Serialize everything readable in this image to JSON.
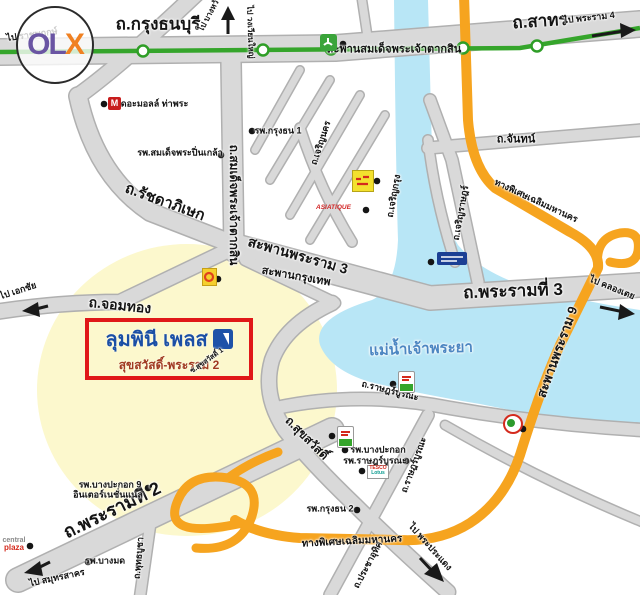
{
  "watermark": {
    "o": "O",
    "l": "L",
    "x": "X",
    "colors": {
      "ol": "#6a55a3",
      "x": "#f08122"
    }
  },
  "property": {
    "name": "ลุมพินี เพลส",
    "subtitle": "สุขสวัสดิ์-พระราม 2"
  },
  "landmarks": {
    "mall_logo": "M",
    "asiatique": "ASIATIQUE",
    "tesco_line1": "TESCO",
    "tesco_line2": "Lotus",
    "central_line1": "central",
    "central_line2": "plaza"
  },
  "colors": {
    "road_gray": "#d9d9d9",
    "road_casing": "#b0b0b0",
    "bts_green": "#35a52b",
    "expressway_orange": "#f6a41f",
    "river_blue": "#b8e6f6",
    "river_label_blue": "#4c86c2",
    "highlight_yellow": "#fcf8cd",
    "box_red": "#e01818",
    "lpn_blue": "#1e52a8"
  },
  "labels": [
    {
      "id": "krungthonburi-rd",
      "text": "ถ.กรุงธนบุรี",
      "x": 158,
      "y": 24,
      "fs": 17,
      "rot": 0
    },
    {
      "id": "sathorn-rd",
      "text": "ถ.สาทร",
      "x": 540,
      "y": 21,
      "fs": 17,
      "rot": -4
    },
    {
      "id": "taksin-rd",
      "text": "ถ.สมเด็จพระเจ้าตากสิน",
      "x": 234,
      "y": 205,
      "fs": 12,
      "rot": 90
    },
    {
      "id": "ratchadaphisek-rd",
      "text": "ถ.รัชดาภิเษก",
      "x": 165,
      "y": 202,
      "fs": 15,
      "rot": 20
    },
    {
      "id": "rama3-bridge",
      "text": "สะพานพระราม 3",
      "x": 298,
      "y": 255,
      "fs": 14,
      "rot": 16
    },
    {
      "id": "krungthep-bridge",
      "text": "สะพานกรุงเทพ",
      "x": 296,
      "y": 277,
      "fs": 11,
      "rot": 10
    },
    {
      "id": "rama3-rd",
      "text": "ถ.พระรามที่ 3",
      "x": 513,
      "y": 291,
      "fs": 17,
      "rot": -2
    },
    {
      "id": "chomthong-rd",
      "text": "ถ.จอมทอง",
      "x": 120,
      "y": 305,
      "fs": 14,
      "rot": 6
    },
    {
      "id": "chan-rd",
      "text": "ถ.จันทน์",
      "x": 516,
      "y": 140,
      "fs": 11,
      "rot": 0
    },
    {
      "id": "charoennakhon-rd",
      "text": "ถ.เจริญนคร",
      "x": 321,
      "y": 143,
      "fs": 9,
      "rot": -72
    },
    {
      "id": "charoenkrung-rd",
      "text": "ถ.เจริญกรุง",
      "x": 394,
      "y": 196,
      "fs": 9,
      "rot": -80
    },
    {
      "id": "charoenrat-rd",
      "text": "ถ.เจริญราษฎร์",
      "x": 461,
      "y": 213,
      "fs": 9,
      "rot": -80
    },
    {
      "id": "ratburana-rd-ew",
      "text": "ถ.ราษฎร์บูรณะ",
      "x": 390,
      "y": 391,
      "fs": 9,
      "rot": 14
    },
    {
      "id": "ratburana-rd-ns",
      "text": "ถ.ราษฎร์บูรณะ",
      "x": 414,
      "y": 465,
      "fs": 9,
      "rot": -70
    },
    {
      "id": "suksawat-rd",
      "text": "ถ.สุขสวัสดิ์",
      "x": 307,
      "y": 438,
      "fs": 12,
      "rot": 45
    },
    {
      "id": "rama2-rd",
      "text": "ถ.พระรามที่ 2",
      "x": 112,
      "y": 510,
      "fs": 18,
      "rot": -26
    },
    {
      "id": "prachauthit-rd",
      "text": "ถ.ประชาอุทิศ",
      "x": 368,
      "y": 565,
      "fs": 9,
      "rot": -62
    },
    {
      "id": "phutthabucha-rd",
      "text": "ถ.พุทธบูชา",
      "x": 139,
      "y": 558,
      "fs": 9,
      "rot": -85
    },
    {
      "id": "expressway-north",
      "text": "ทางพิเศษเฉลิมมหานคร",
      "x": 536,
      "y": 201,
      "fs": 9,
      "rot": 25
    },
    {
      "id": "expressway-south",
      "text": "ทางพิเศษเฉลิมมหานคร",
      "x": 352,
      "y": 542,
      "fs": 10,
      "rot": -3
    },
    {
      "id": "rama9-bridge",
      "text": "สะพานพระราม 9",
      "x": 557,
      "y": 352,
      "fs": 13,
      "rot": -70
    },
    {
      "id": "taksin-bts-bridge",
      "text": "สะพานสมเด็จพระเจ้าตากสิน",
      "x": 394,
      "y": 50,
      "fs": 11,
      "rot": 0
    },
    {
      "id": "chaophraya-river",
      "text": "แม่น้ำเจ้าพระยา",
      "x": 421,
      "y": 349,
      "fs": 15,
      "rot": -2,
      "color": "#4c86c2"
    },
    {
      "id": "to-ratchaphruek",
      "text": "ไป ราชพฤกษ์",
      "x": 32,
      "y": 35,
      "fs": 9,
      "rot": -8
    },
    {
      "id": "to-bangwa",
      "text": "ไป บางหว้า",
      "x": 210,
      "y": 14,
      "fs": 8,
      "rot": -62
    },
    {
      "id": "to-wongwianyai",
      "text": "ไป วงเวียนใหญ่",
      "x": 250,
      "y": 32,
      "fs": 8,
      "rot": 88
    },
    {
      "id": "to-rama4",
      "text": "ไป พระราม 4",
      "x": 589,
      "y": 18,
      "fs": 9,
      "rot": -6
    },
    {
      "id": "to-khlongtoei",
      "text": "ไป คลองเตย",
      "x": 612,
      "y": 288,
      "fs": 9,
      "rot": 22
    },
    {
      "id": "to-ekkachai",
      "text": "ไป เอกชัย",
      "x": 18,
      "y": 291,
      "fs": 9,
      "rot": -18
    },
    {
      "id": "to-samutsakhon",
      "text": "ไป สมุทรสาคร",
      "x": 57,
      "y": 578,
      "fs": 9,
      "rot": -12
    },
    {
      "id": "to-phrapradaeng",
      "text": "ไป พระประแดง",
      "x": 430,
      "y": 547,
      "fs": 9,
      "rot": 48
    },
    {
      "id": "the-mall-thapra",
      "text": "เดอะมอลล์ ท่าพระ",
      "x": 153,
      "y": 104,
      "fs": 9,
      "rot": 0
    },
    {
      "id": "krungthon1-hospital",
      "text": "รพ.กรุงธน 1",
      "x": 278,
      "y": 131,
      "fs": 9,
      "rot": 0
    },
    {
      "id": "pinklao-hospital",
      "text": "รพ.สมเด็จพระปิ่นเกล้า",
      "x": 180,
      "y": 153,
      "fs": 9,
      "rot": 0
    },
    {
      "id": "krungthon2-hospital",
      "text": "รพ.กรุงธน 2",
      "x": 330,
      "y": 509,
      "fs": 9,
      "rot": 0
    },
    {
      "id": "bangpakok9-hospital-1",
      "text": "รพ.บางปะกอก 9",
      "x": 110,
      "y": 485,
      "fs": 9,
      "rot": 0
    },
    {
      "id": "bangpakok9-hospital-2",
      "text": "อินเตอร์เนชั่นแนล",
      "x": 108,
      "y": 495,
      "fs": 9,
      "rot": 0
    },
    {
      "id": "bangmot-hospital",
      "text": "รพ.บางมด",
      "x": 105,
      "y": 561,
      "fs": 9,
      "rot": 0
    },
    {
      "id": "bangpakok-hospital",
      "text": "รพ.บางปะกอก",
      "x": 378,
      "y": 450,
      "fs": 9,
      "rot": 0
    },
    {
      "id": "ratburana-hospital",
      "text": "รพ.ราษฎร์บูรณะ",
      "x": 375,
      "y": 461,
      "fs": 9,
      "rot": 0
    },
    {
      "id": "soi-suksawat1",
      "text": "ซ.สุขสวัสดิ์ 1",
      "x": 207,
      "y": 361,
      "fs": 7,
      "rot": -35
    }
  ]
}
